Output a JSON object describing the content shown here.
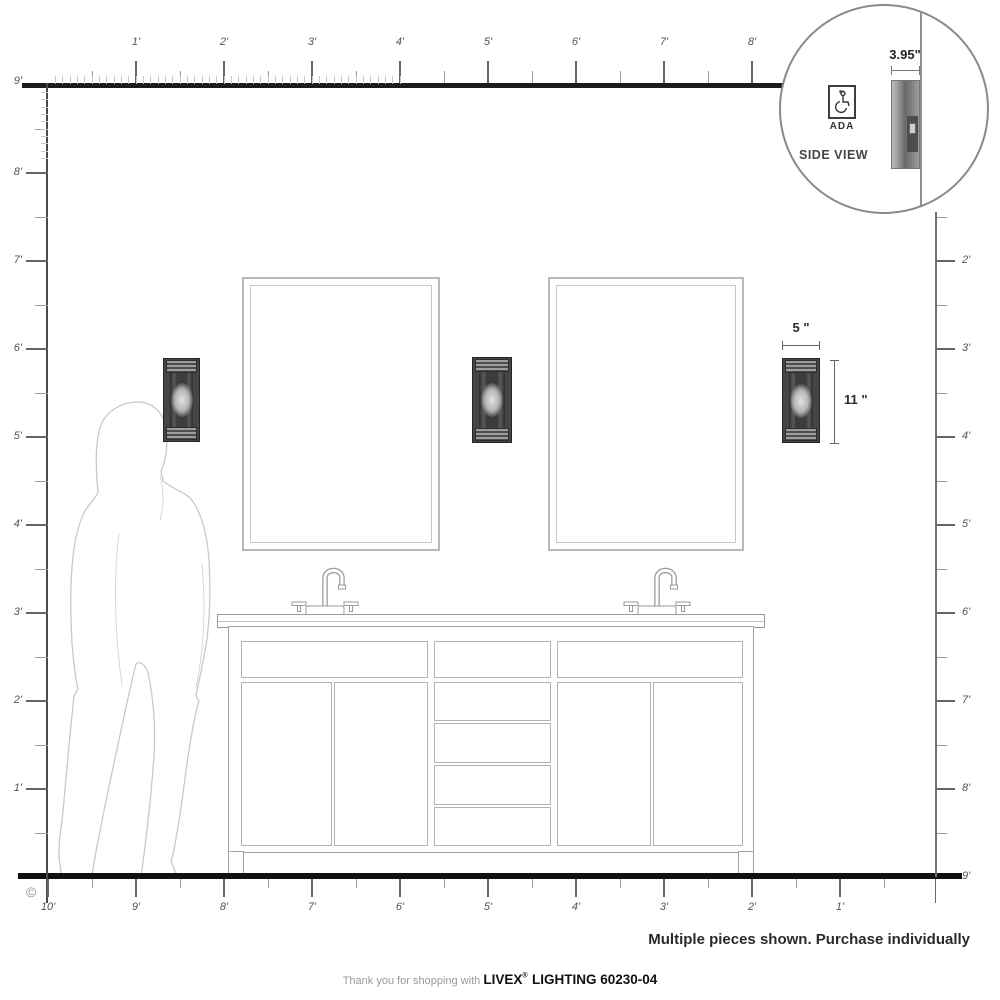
{
  "page": {
    "copyright": "©",
    "footer_note": "Multiple pieces shown. Purchase individually",
    "tagline_prefix": "Thank you for shopping with ",
    "brand": "LIVEX",
    "brand_reg": "®",
    "brand_suffix": " LIGHTING 60230-04"
  },
  "inset": {
    "dimension_label": "3.95\"",
    "ada_label": "ADA",
    "ada_icon": "wheelchair",
    "side_view_label": "SIDE VIEW"
  },
  "fixture_annotations": {
    "width_label": "5 \"",
    "height_label": "11 \""
  },
  "rulers": {
    "top": {
      "origin_label": "9'",
      "unit_labels": [
        "1'",
        "2'",
        "3'",
        "4'",
        "5'",
        "6'",
        "7'",
        "8'"
      ]
    },
    "left": {
      "unit_labels": [
        "8'",
        "7'",
        "6'",
        "5'",
        "4'",
        "3'",
        "2'",
        "1'"
      ]
    },
    "right": {
      "unit_labels": [
        "2'",
        "3'",
        "4'",
        "5'",
        "6'",
        "7'",
        "8'"
      ],
      "floor_label": "9'"
    },
    "bottom": {
      "unit_labels": [
        "10'",
        "9'",
        "8'",
        "7'",
        "6'",
        "5'",
        "4'",
        "3'",
        "2'",
        "1'"
      ]
    }
  },
  "scene": {
    "wall_sconces": 3,
    "mirrors": 2,
    "vanity": "double-sink vanity with two doors each side and center drawer stack",
    "figure": "female silhouette for scale"
  }
}
